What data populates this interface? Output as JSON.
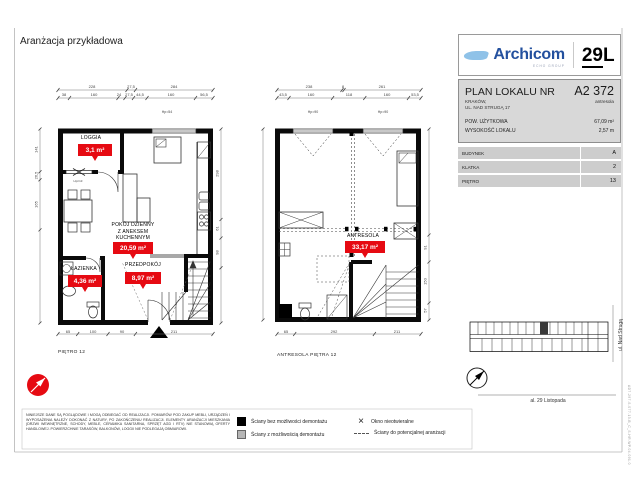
{
  "note": "Aranżacja przykładowa",
  "brand": {
    "archicom": "Archicom",
    "archicom_sub": "ECHO GROUP",
    "project_a": "29",
    "project_b": "L"
  },
  "header": {
    "title": "PLAN LOKALU NR",
    "unit": "A2 372",
    "unit_sub": "antresola",
    "city": "KRAKÓW,",
    "street": "UL. NAD STRUGĄ 17",
    "rows": [
      {
        "label": "POW. UŻYTKOWA",
        "value": "67,09 m²"
      },
      {
        "label": "WYSOKOŚĆ LOKALU",
        "value": "2,57 m"
      }
    ]
  },
  "info": {
    "rows": [
      {
        "label": "BUDYNEK",
        "value": "A"
      },
      {
        "label": "KLATKA",
        "value": "2"
      },
      {
        "label": "PIĘTRO",
        "value": "13"
      }
    ]
  },
  "location": {
    "side_street": "ul. Nad Strugą",
    "bottom_street": "al. 29 Listopada"
  },
  "floor": {
    "caption": "PIĘTRO 12",
    "loggia_name": "LOGGIA",
    "loggia_area": "3,1 m²",
    "living_l1": "POKÓJ DZIENNY",
    "living_l2": "Z ANEKSEM",
    "living_l3": "KUCHENNYM",
    "living_area": "20,59 m²",
    "bath_name": "ŁAZIENKA",
    "bath_area": "4,36 m²",
    "hall_name": "PRZEDPOKÓJ",
    "hall_area": "8,97 m²",
    "win_top": "Hp=54",
    "win_loggia": "Hp=13",
    "dims": {
      "top1": [
        "228",
        "27,5",
        "284"
      ],
      "top2": [
        "38",
        "160",
        "24",
        "27,5",
        "44,5",
        "160",
        "56,5"
      ],
      "left": [
        "141",
        "26,5",
        "165"
      ],
      "right": [
        "298",
        "61",
        "98"
      ],
      "bottom": [
        "65",
        "100",
        "90",
        "211"
      ]
    }
  },
  "mezz": {
    "caption": "ANTRESOLA PIĘTRA 12",
    "name": "ANTRESOLA",
    "area": "33,17 m²",
    "win1": "Hp=90",
    "win2": "Hp=90",
    "dims": {
      "top1": [
        "238",
        "8",
        "261"
      ],
      "top2": [
        "43,5",
        "160",
        "118",
        "160",
        "53,5"
      ],
      "right": [
        "91",
        "150",
        "57"
      ],
      "bottom": [
        "65",
        "292",
        "211"
      ]
    }
  },
  "legend": {
    "disclaimer": "NINIEJSZE DANE SĄ POGLĄDOWE I MOGĄ ODBIEGAĆ OD REALIZACJI. POMIARÓW POD ZAKUP MEBLI, URZĄDZEŃ I WYPOSAŻENIA NALEŻY DOKONAĆ Z NATURY, PO ZAKOŃCZENIU REALIZACJI. ELEMENTY ARANŻACJI MIESZKANIA (DRZWI WEWNĘTRZNE, SCHODY, MEBLE, CERAMIKA SANITARNA, SPRZĘT AGD I RTV) NIE STANOWIĄ OFERTY HANDLOWEJ. POWIERZCHNIE TARASÓW, BALKONÓW, LOGGII NIE PODLEGAJĄ OBMIAROWI.",
    "wall_fixed": "Ściany bez możliwości demontażu",
    "wall_removable": "Ściany z możliwością demontażu",
    "window_fixed": "Okno nieotwieralne",
    "wall_optional": "Ściany do potencjalnej aranżacji",
    "x_glyph": "×"
  },
  "edge_print": "AD7.297.S.077.13.B_C_S.HR.WP.04.091.0"
}
